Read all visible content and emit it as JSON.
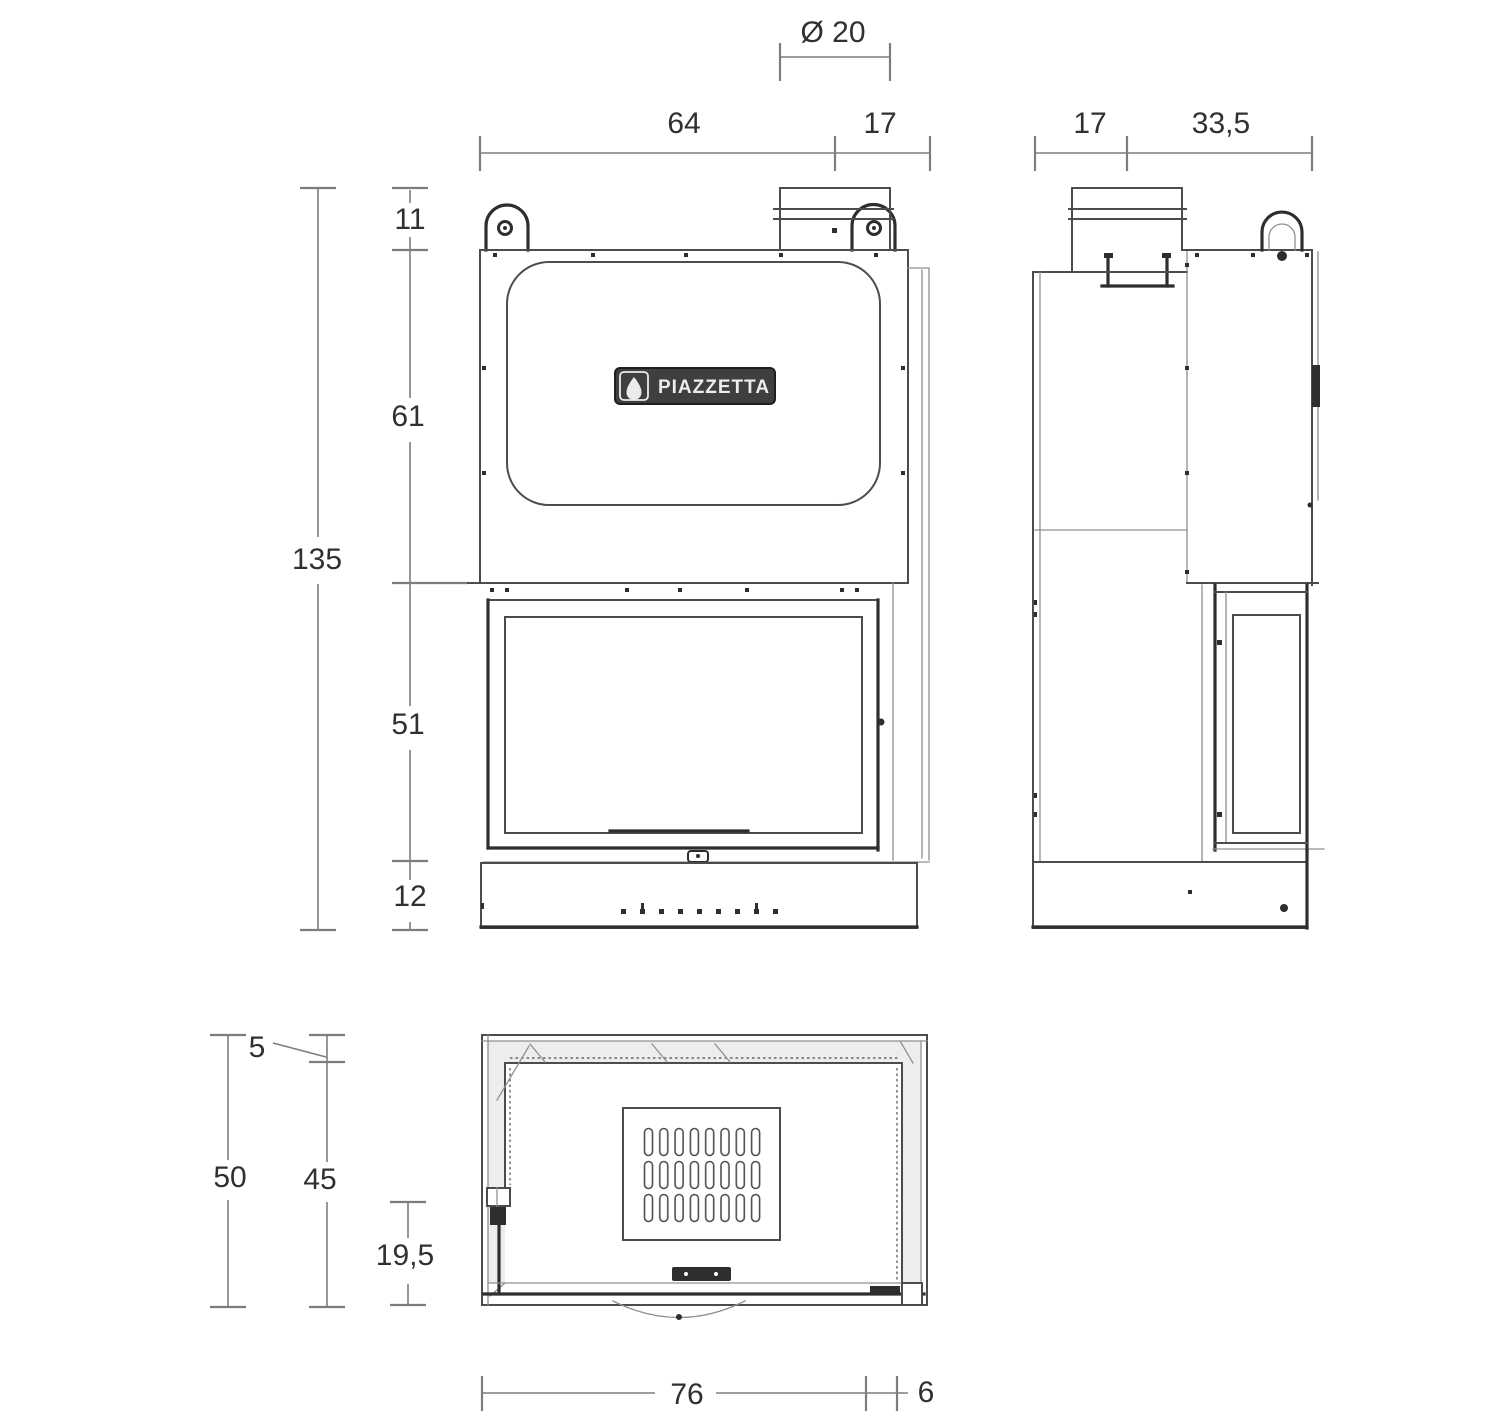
{
  "drawing": {
    "brand_badge": "PIAZZETTA"
  },
  "dimensions": {
    "front": {
      "flue_diameter": "Ø 20",
      "width_body": "64",
      "width_flue_to_edge": "17",
      "height_lug": "11",
      "height_upper": "61",
      "height_door": "51",
      "height_base": "12",
      "height_total": "135"
    },
    "side": {
      "depth_rear_to_flue": "17",
      "depth_flue_to_front": "33,5"
    },
    "top": {
      "depth_total": "50",
      "depth_rear_gap": "5",
      "depth_inner": "45",
      "depth_front_section": "19,5",
      "width_body": "76",
      "width_side_panel": "6"
    }
  },
  "colors": {
    "background": "#ffffff",
    "line": "#4c4c4c",
    "line_bold": "#2e2e2e",
    "line_thin": "#909090",
    "dim_line": "#7d7d7d",
    "dim_text": "#303030",
    "badge_bg": "#3f3f3f",
    "badge_fg": "#ececec",
    "band_fill": "#ededed"
  }
}
